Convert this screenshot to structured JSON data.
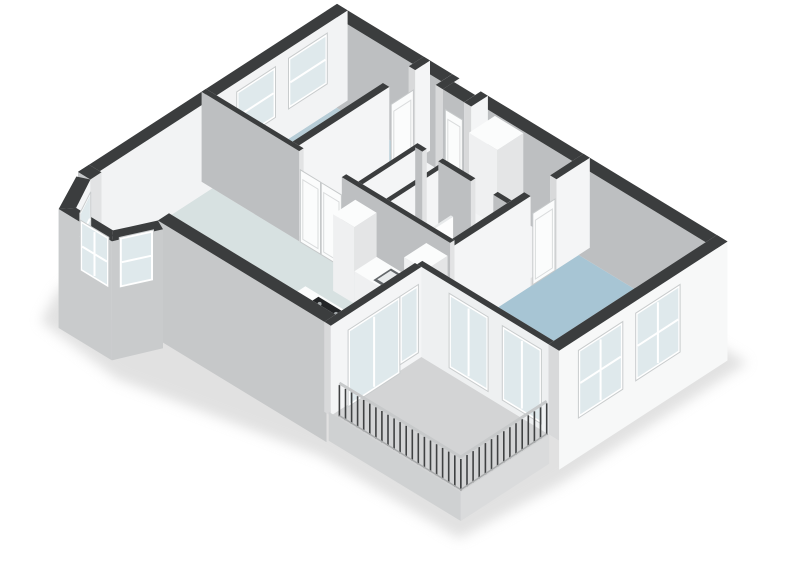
{
  "canvas": {
    "w": 800,
    "h": 566,
    "background": "#ffffff"
  },
  "title": "3d-floorplan-apartment",
  "rooms": [
    {
      "name": "living-room"
    },
    {
      "name": "bay-window"
    },
    {
      "name": "study"
    },
    {
      "name": "entrance-hall"
    },
    {
      "name": "corridor"
    },
    {
      "name": "wc"
    },
    {
      "name": "shower-room"
    },
    {
      "name": "kitchen-open"
    },
    {
      "name": "bedroom"
    },
    {
      "name": "balcony"
    }
  ],
  "colors": {
    "background": "#ffffff",
    "wall_cap": "#3b3d3e",
    "wall_exterior_gray": "#c6c8c9",
    "wall_interior_shaded": "#bdbfc1",
    "wall_interior_light": "#f6f7f7",
    "floor_living": "#d7e1e1",
    "floor_study": "#b7cdd7",
    "floor_bedroom": "#a7c5d4",
    "floor_shower": "#2f9ecb",
    "floor_balcony": "#d3d4d5",
    "floor_hall": "#f3f4f5",
    "floor_bath": "#eef1f2",
    "glass": "#dfe9ec",
    "cooktop": "#232527",
    "oven": "#2b2d2e",
    "rail_post": "#3f4142",
    "rail_top": "#c7c9ca",
    "wall_defaults": {
      "x": {
        "front": "#bdbfc1",
        "back": "#f6f7f7",
        "end": "#e2e3e4",
        "cap": "#3b3d3e"
      },
      "y": {
        "front": "#f4f5f6",
        "back": "#eaebec",
        "end": "#d8d9da",
        "cap": "#3b3d3e"
      }
    }
  },
  "projection": {
    "ox": 78,
    "oy": 262,
    "ax": [
      35.5,
      21.6
    ],
    "ay": [
      37,
      -24
    ],
    "az": 34
  },
  "scene": [
    {
      "t": "flat",
      "n": "ground-shadow",
      "z": -0.9,
      "c": "#c9c9c9",
      "blur": true,
      "opacity": 0.55,
      "pts": [
        [
          -0.35,
          -0.2
        ],
        [
          -0.35,
          7.25
        ],
        [
          11.3,
          7.25
        ],
        [
          11.3,
          2.2
        ],
        [
          11.05,
          -0.3
        ],
        [
          7.2,
          -0.35
        ],
        [
          2.5,
          -1.35
        ],
        [
          0.1,
          -1.1
        ]
      ]
    },
    {
      "t": "floor",
      "n": "corridor-floor",
      "c": "#f3f4f5",
      "pts": [
        [
          2.62,
          5.06
        ],
        [
          6.94,
          5.06
        ],
        [
          6.94,
          6.7
        ],
        [
          2.62,
          6.7
        ]
      ]
    },
    {
      "t": "floor",
      "n": "inner-hall-floor",
      "c": "#f3f4f5",
      "pts": [
        [
          2.62,
          3.46
        ],
        [
          4.29,
          3.46
        ],
        [
          4.29,
          4.94
        ],
        [
          2.62,
          4.94
        ]
      ]
    },
    {
      "t": "floor",
      "n": "wc-floor",
      "c": "#f0f2f3",
      "pts": [
        [
          4.41,
          3.46
        ],
        [
          5.08,
          3.46
        ],
        [
          5.08,
          4.94
        ],
        [
          4.41,
          4.94
        ]
      ]
    },
    {
      "t": "floor",
      "n": "bathroom-floor",
      "c": "#eef1f2",
      "pts": [
        [
          5.2,
          3.46
        ],
        [
          6.94,
          3.46
        ],
        [
          6.94,
          4.94
        ],
        [
          5.2,
          4.94
        ]
      ]
    },
    {
      "t": "floor",
      "n": "shower-floor",
      "c": "#2f9ecb",
      "pts": [
        [
          5.2,
          3.46
        ],
        [
          5.9,
          3.46
        ],
        [
          5.9,
          4.4
        ],
        [
          5.2,
          4.4
        ]
      ]
    },
    {
      "t": "floor",
      "n": "study-floor",
      "c": "#b7cdd7",
      "pts": [
        [
          0.3,
          3.46
        ],
        [
          2.44,
          3.46
        ],
        [
          2.44,
          6.7
        ],
        [
          0.3,
          6.7
        ]
      ]
    },
    {
      "t": "floor",
      "n": "bedroom-floor",
      "c": "#a7c5d4",
      "pts": [
        [
          7.12,
          2.59
        ],
        [
          10.7,
          2.59
        ],
        [
          10.7,
          6.7
        ],
        [
          7.12,
          6.7
        ]
      ]
    },
    {
      "t": "floor",
      "n": "living-room-floor",
      "c": "#d7e1e1",
      "pts": [
        [
          0.3,
          0.3
        ],
        [
          6.94,
          0.3
        ],
        [
          6.94,
          3.34
        ],
        [
          0.3,
          3.34
        ]
      ]
    },
    {
      "t": "floor",
      "n": "balcony-floor",
      "c": "#d3d4d5",
      "pts": [
        [
          7.0,
          0.06
        ],
        [
          10.72,
          0.06
        ],
        [
          10.72,
          2.45
        ],
        [
          7.0,
          2.45
        ]
      ]
    },
    {
      "t": "floor",
      "n": "bay-floor",
      "c": "#eef0f0",
      "pts": [
        [
          0.35,
          0.3
        ],
        [
          0.35,
          0
        ],
        [
          0.78,
          -0.8
        ],
        [
          1.82,
          -0.8
        ],
        [
          2.25,
          0
        ],
        [
          2.25,
          0.3
        ]
      ]
    },
    {
      "t": "wall",
      "n": "exterior-wall-north",
      "o": "x",
      "c1": 6.7,
      "c2": 7.0,
      "spans": [
        [
          0,
          3.25
        ],
        [
          4.25,
          11
        ]
      ],
      "h": 2.65
    },
    {
      "t": "wall",
      "n": "entrance-notch-left",
      "o": "y",
      "c1": 3.25,
      "c2": 3.45,
      "spans": [
        [
          6.55,
          7.0
        ]
      ],
      "h": 2.65
    },
    {
      "t": "wall",
      "n": "entrance-notch-front",
      "o": "x",
      "c1": 6.55,
      "c2": 6.85,
      "spans": [
        [
          3.45,
          4.05
        ]
      ],
      "h": 2.65
    },
    {
      "t": "win",
      "n": "entrance-door",
      "door": true,
      "a": [
        3.52,
        6.55
      ],
      "b": [
        4.0,
        6.55
      ],
      "z0": 0,
      "z1": 2.1
    },
    {
      "t": "wall",
      "n": "entrance-notch-right",
      "o": "y",
      "c1": 4.05,
      "c2": 4.25,
      "spans": [
        [
          6.55,
          7.0
        ]
      ],
      "h": 2.65
    },
    {
      "t": "wall",
      "n": "exterior-wall-west",
      "o": "y",
      "c1": 0,
      "c2": 0.3,
      "spans": [
        [
          0,
          7
        ]
      ],
      "h": 2.65,
      "f": {
        "front": "#f2f3f4",
        "end": "#d4d5d6"
      }
    },
    {
      "t": "win",
      "n": "study-window-1",
      "a": [
        0.3,
        4.05
      ],
      "b": [
        0.3,
        5.0
      ],
      "z0": 0.95,
      "z1": 2.3,
      "panes": 1,
      "sash": true
    },
    {
      "t": "win",
      "n": "study-window-2",
      "a": [
        0.3,
        5.45
      ],
      "b": [
        0.3,
        6.4
      ],
      "z0": 0.95,
      "z1": 2.3,
      "panes": 1,
      "sash": true
    },
    {
      "t": "wall",
      "n": "study-east-wall",
      "o": "y",
      "c1": 2.44,
      "c2": 2.62,
      "spans": [
        [
          3.4,
          5.9
        ],
        [
          6.6,
          7.0
        ]
      ],
      "h": 2.65
    },
    {
      "t": "win",
      "n": "study-door",
      "door": true,
      "a": [
        2.62,
        5.95
      ],
      "b": [
        2.62,
        6.55
      ],
      "z0": 0,
      "z1": 2.1
    },
    {
      "t": "wall",
      "n": "wc-west-wall",
      "o": "y",
      "c1": 4.29,
      "c2": 4.41,
      "spans": [
        [
          3.4,
          5.06
        ]
      ],
      "h": 2.65
    },
    {
      "t": "wall",
      "n": "wc-east-wall",
      "o": "y",
      "c1": 5.08,
      "c2": 5.2,
      "spans": [
        [
          3.4,
          5.06
        ]
      ],
      "h": 2.65
    },
    {
      "t": "box",
      "n": "hall-closet",
      "x1": 4.5,
      "y1": 6.25,
      "x2": 5.3,
      "y2": 6.95,
      "h": 2.25
    },
    {
      "t": "wall",
      "n": "bathroom-north-wall",
      "o": "x",
      "c1": 4.94,
      "c2": 5.06,
      "spans": [
        [
          4.35,
          4.55
        ],
        [
          5.0,
          5.92
        ],
        [
          6.55,
          6.94
        ]
      ],
      "h": 2.65
    },
    {
      "t": "box",
      "n": "toilet-tank",
      "x1": 4.56,
      "y1": 3.46,
      "x2": 4.86,
      "y2": 3.64,
      "h": 0.78
    },
    {
      "t": "box",
      "n": "toilet-bowl",
      "x1": 4.52,
      "y1": 3.62,
      "x2": 4.9,
      "y2": 4.04,
      "h": 0.44
    },
    {
      "t": "wall",
      "n": "shower-glass-screen",
      "o": "y",
      "c1": 5.9,
      "c2": 5.96,
      "spans": [
        [
          3.46,
          4.42
        ]
      ],
      "h": 2.0,
      "f": {
        "front": "#fdfdfd",
        "back": "#f1f2f3",
        "end": "#eceded",
        "cap": "#e8eaeb"
      }
    },
    {
      "t": "box",
      "n": "vanity-unit",
      "x1": 6.05,
      "y1": 3.5,
      "x2": 6.95,
      "y2": 3.96,
      "h": 0.85
    },
    {
      "t": "flat",
      "n": "vanity-basin-1",
      "z": 0.86,
      "c": "#e9edee",
      "pts": [
        [
          6.12,
          3.58
        ],
        [
          6.42,
          3.58
        ],
        [
          6.42,
          3.9
        ],
        [
          6.12,
          3.9
        ]
      ]
    },
    {
      "t": "flat",
      "n": "vanity-basin-2",
      "z": 0.86,
      "c": "#e9edee",
      "pts": [
        [
          6.53,
          3.58
        ],
        [
          6.83,
          3.58
        ],
        [
          6.83,
          3.9
        ],
        [
          6.53,
          3.9
        ]
      ]
    },
    {
      "t": "dot",
      "n": "vanity-tap-1",
      "x": 6.27,
      "y": 3.54,
      "z": 0.98,
      "r": 2,
      "c": "#8f9496"
    },
    {
      "t": "dot",
      "n": "vanity-tap-2",
      "x": 6.68,
      "y": 3.54,
      "z": 0.98,
      "r": 2,
      "c": "#8f9496"
    },
    {
      "t": "wall",
      "n": "bedroom-west-wall",
      "o": "y",
      "c1": 6.94,
      "c2": 7.12,
      "spans": [
        [
          2.45,
          5.4
        ],
        [
          6.1,
          7.0
        ]
      ],
      "h": 2.65
    },
    {
      "t": "win",
      "n": "bedroom-door",
      "door": true,
      "a": [
        7.12,
        5.46
      ],
      "b": [
        7.12,
        6.06
      ],
      "z0": 0,
      "z1": 2.1
    },
    {
      "t": "wall",
      "n": "living-north-wall",
      "o": "x",
      "c1": 3.34,
      "c2": 3.46,
      "spans": [
        [
          0,
          2.75
        ],
        [
          3.95,
          7.0
        ]
      ],
      "h": 2.65
    },
    {
      "t": "win",
      "n": "hall-double-door-left",
      "door": true,
      "a": [
        2.78,
        3.34
      ],
      "b": [
        3.35,
        3.34
      ],
      "z0": 0,
      "z1": 2.12
    },
    {
      "t": "win",
      "n": "hall-double-door-right",
      "door": true,
      "a": [
        3.37,
        3.34
      ],
      "b": [
        3.94,
        3.34
      ],
      "z0": 0,
      "z1": 2.12
    },
    {
      "t": "box",
      "n": "kitchen-tall-cabinet",
      "x1": 4.35,
      "y1": 2.72,
      "x2": 4.95,
      "y2": 3.32,
      "h": 2.25
    },
    {
      "t": "box",
      "n": "kitchen-counter",
      "x1": 4.95,
      "y1": 2.72,
      "x2": 6.35,
      "y2": 3.32,
      "h": 0.95
    },
    {
      "t": "flat",
      "n": "kitchen-sink-rim",
      "z": 0.95,
      "c": "#63676a",
      "pts": [
        [
          5.42,
          2.78
        ],
        [
          5.92,
          2.78
        ],
        [
          5.92,
          3.26
        ],
        [
          5.42,
          3.26
        ]
      ]
    },
    {
      "t": "flat",
      "n": "kitchen-sink-basin",
      "z": 0.96,
      "c": "#e8ebec",
      "pts": [
        [
          5.47,
          2.84
        ],
        [
          5.87,
          2.84
        ],
        [
          5.87,
          3.2
        ],
        [
          5.47,
          3.2
        ]
      ]
    },
    {
      "t": "dot",
      "n": "kitchen-faucet",
      "x": 5.85,
      "y": 3.22,
      "z": 1.05,
      "r": 2,
      "c": "#9aa0a2"
    },
    {
      "t": "box",
      "n": "oven-tower",
      "x1": 6.35,
      "y1": 2.72,
      "x2": 6.95,
      "y2": 3.32,
      "h": 2.25
    },
    {
      "t": "win",
      "n": "oven-front",
      "frame": false,
      "glass": "#2b2d2e",
      "a": [
        6.88,
        2.72
      ],
      "b": [
        6.42,
        2.72
      ],
      "z0": 0.9,
      "z1": 1.8,
      "panes": 1
    },
    {
      "t": "box",
      "n": "kitchen-island",
      "x1": 4.55,
      "y1": 1.08,
      "x2": 6.25,
      "y2": 1.78,
      "h": 0.92
    },
    {
      "t": "flat",
      "n": "cooktop",
      "z": 0.93,
      "c": "#232527",
      "pts": [
        [
          4.98,
          1.16
        ],
        [
          5.88,
          1.16
        ],
        [
          5.88,
          1.72
        ],
        [
          4.98,
          1.72
        ]
      ]
    },
    {
      "t": "dot",
      "n": "burner-1",
      "x": 5.16,
      "y": 1.3,
      "z": 0.93,
      "r": 2,
      "c": "#a0a5a7"
    },
    {
      "t": "dot",
      "n": "burner-2",
      "x": 5.16,
      "y": 1.58,
      "z": 0.93,
      "r": 2,
      "c": "#a0a5a7"
    },
    {
      "t": "dot",
      "n": "burner-3",
      "x": 5.62,
      "y": 1.3,
      "z": 0.93,
      "r": 2,
      "c": "#a0a5a7"
    },
    {
      "t": "dot",
      "n": "burner-4",
      "x": 5.62,
      "y": 1.58,
      "z": 0.93,
      "r": 2,
      "c": "#a0a5a7"
    },
    {
      "t": "wall",
      "n": "exterior-wall-south",
      "o": "x",
      "c1": 0,
      "c2": 0.3,
      "spans": [
        [
          0,
          0.35
        ],
        [
          2.25,
          7.0
        ]
      ],
      "h": 2.65,
      "zb": -0.85,
      "f": {
        "front": "#c6c8c9"
      }
    },
    {
      "t": "wq",
      "n": "bay-segment-1",
      "in": [
        [
          0.35,
          0
        ],
        [
          0.78,
          -0.8
        ]
      ],
      "out": [
        [
          0.08,
          -0.12
        ],
        [
          0.55,
          -1.05
        ]
      ],
      "h": 2.65,
      "zb": -0.85,
      "fi": "#f4f5f6",
      "fo": "#c9cbcc",
      "cap": "#3b3d3e"
    },
    {
      "t": "wq",
      "n": "bay-segment-2",
      "in": [
        [
          0.78,
          -0.8
        ],
        [
          1.82,
          -0.8
        ]
      ],
      "out": [
        [
          0.55,
          -1.05
        ],
        [
          2.05,
          -1.05
        ]
      ],
      "h": 2.65,
      "zb": -0.85,
      "fi": "#f4f5f6",
      "fo": "#c9cbcc",
      "cap": "#3b3d3e"
    },
    {
      "t": "wq",
      "n": "bay-segment-3",
      "in": [
        [
          1.82,
          -0.8
        ],
        [
          2.25,
          0
        ]
      ],
      "out": [
        [
          2.05,
          -1.05
        ],
        [
          2.52,
          -0.12
        ]
      ],
      "h": 2.65,
      "zb": -0.85,
      "fi": "#eef0f1",
      "fo": "#c9cbcc",
      "cap": "#3b3d3e"
    },
    {
      "t": "win",
      "n": "bay-window-1",
      "a": [
        0.44,
        -0.1
      ],
      "b": [
        0.72,
        -0.62
      ],
      "z0": 0.95,
      "z1": 2.3,
      "panes": 1,
      "sash": true
    },
    {
      "t": "win",
      "n": "bay-window-2",
      "a": [
        0.95,
        -0.8
      ],
      "b": [
        1.65,
        -0.8
      ],
      "z0": 0.95,
      "z1": 2.3,
      "panes": 2,
      "sash": true
    },
    {
      "t": "win",
      "n": "bay-window-3",
      "a": [
        1.88,
        -0.62
      ],
      "b": [
        2.16,
        -0.1
      ],
      "z0": 0.95,
      "z1": 2.3,
      "panes": 1,
      "sash": true
    },
    {
      "t": "wall",
      "n": "bedroom-south-wall",
      "o": "x",
      "c1": 2.45,
      "c2": 2.59,
      "spans": [
        [
          7.0,
          11
        ]
      ],
      "h": 2.65,
      "f": {
        "front": "#eef0f1"
      }
    },
    {
      "t": "win",
      "n": "bedroom-balcony-window-1",
      "a": [
        7.95,
        2.45
      ],
      "b": [
        8.95,
        2.45
      ],
      "z0": 0.25,
      "z1": 2.3,
      "panes": 2
    },
    {
      "t": "win",
      "n": "bedroom-balcony-window-2",
      "a": [
        9.45,
        2.45
      ],
      "b": [
        10.45,
        2.45
      ],
      "z0": 0.25,
      "z1": 2.3,
      "panes": 2
    },
    {
      "t": "wall",
      "n": "exterior-wall-east",
      "o": "y",
      "c1": 10.7,
      "c2": 11.0,
      "spans": [
        [
          2.45,
          7.0
        ]
      ],
      "h": 2.65,
      "zb": -0.85,
      "f": {
        "front": "#f7f8f8"
      }
    },
    {
      "t": "win",
      "n": "bedroom-east-window-1",
      "a": [
        11.02,
        3.0
      ],
      "b": [
        11.02,
        4.1
      ],
      "z0": 0.4,
      "z1": 2.25,
      "panes": 2,
      "sash": true
    },
    {
      "t": "win",
      "n": "bedroom-east-window-2",
      "a": [
        11.02,
        4.55
      ],
      "b": [
        11.02,
        5.65
      ],
      "z0": 0.4,
      "z1": 2.25,
      "panes": 2,
      "sash": true
    },
    {
      "t": "wall",
      "n": "living-balcony-wall",
      "o": "y",
      "c1": 6.94,
      "c2": 7.12,
      "spans": [
        [
          0,
          2.45
        ]
      ],
      "h": 2.65,
      "f": {
        "front": "#f4f5f6"
      }
    },
    {
      "t": "win",
      "n": "balcony-glazed-door",
      "a": [
        7.12,
        0.52
      ],
      "b": [
        7.12,
        1.82
      ],
      "z0": 0,
      "z1": 2.12,
      "panes": 2
    },
    {
      "t": "win",
      "n": "balcony-sidelight",
      "a": [
        7.12,
        1.92
      ],
      "b": [
        7.12,
        2.32
      ],
      "z0": 0.25,
      "z1": 2.12,
      "panes": 1
    },
    {
      "t": "vf",
      "n": "balcony-slab-front",
      "a": [
        7.0,
        0.06
      ],
      "b": [
        10.72,
        0.06
      ],
      "z0": -0.85,
      "z1": 0,
      "c": "#cfd1d2"
    },
    {
      "t": "vf",
      "n": "balcony-slab-end",
      "a": [
        10.72,
        0.06
      ],
      "b": [
        10.72,
        2.45
      ],
      "z0": -0.85,
      "z1": 0,
      "c": "#dadbdc"
    },
    {
      "t": "rail",
      "n": "balcony-railing",
      "path": [
        [
          7.26,
          0.1
        ],
        [
          10.68,
          0.1
        ],
        [
          10.68,
          2.42
        ]
      ],
      "h": 0.98,
      "step": 0.17
    }
  ]
}
